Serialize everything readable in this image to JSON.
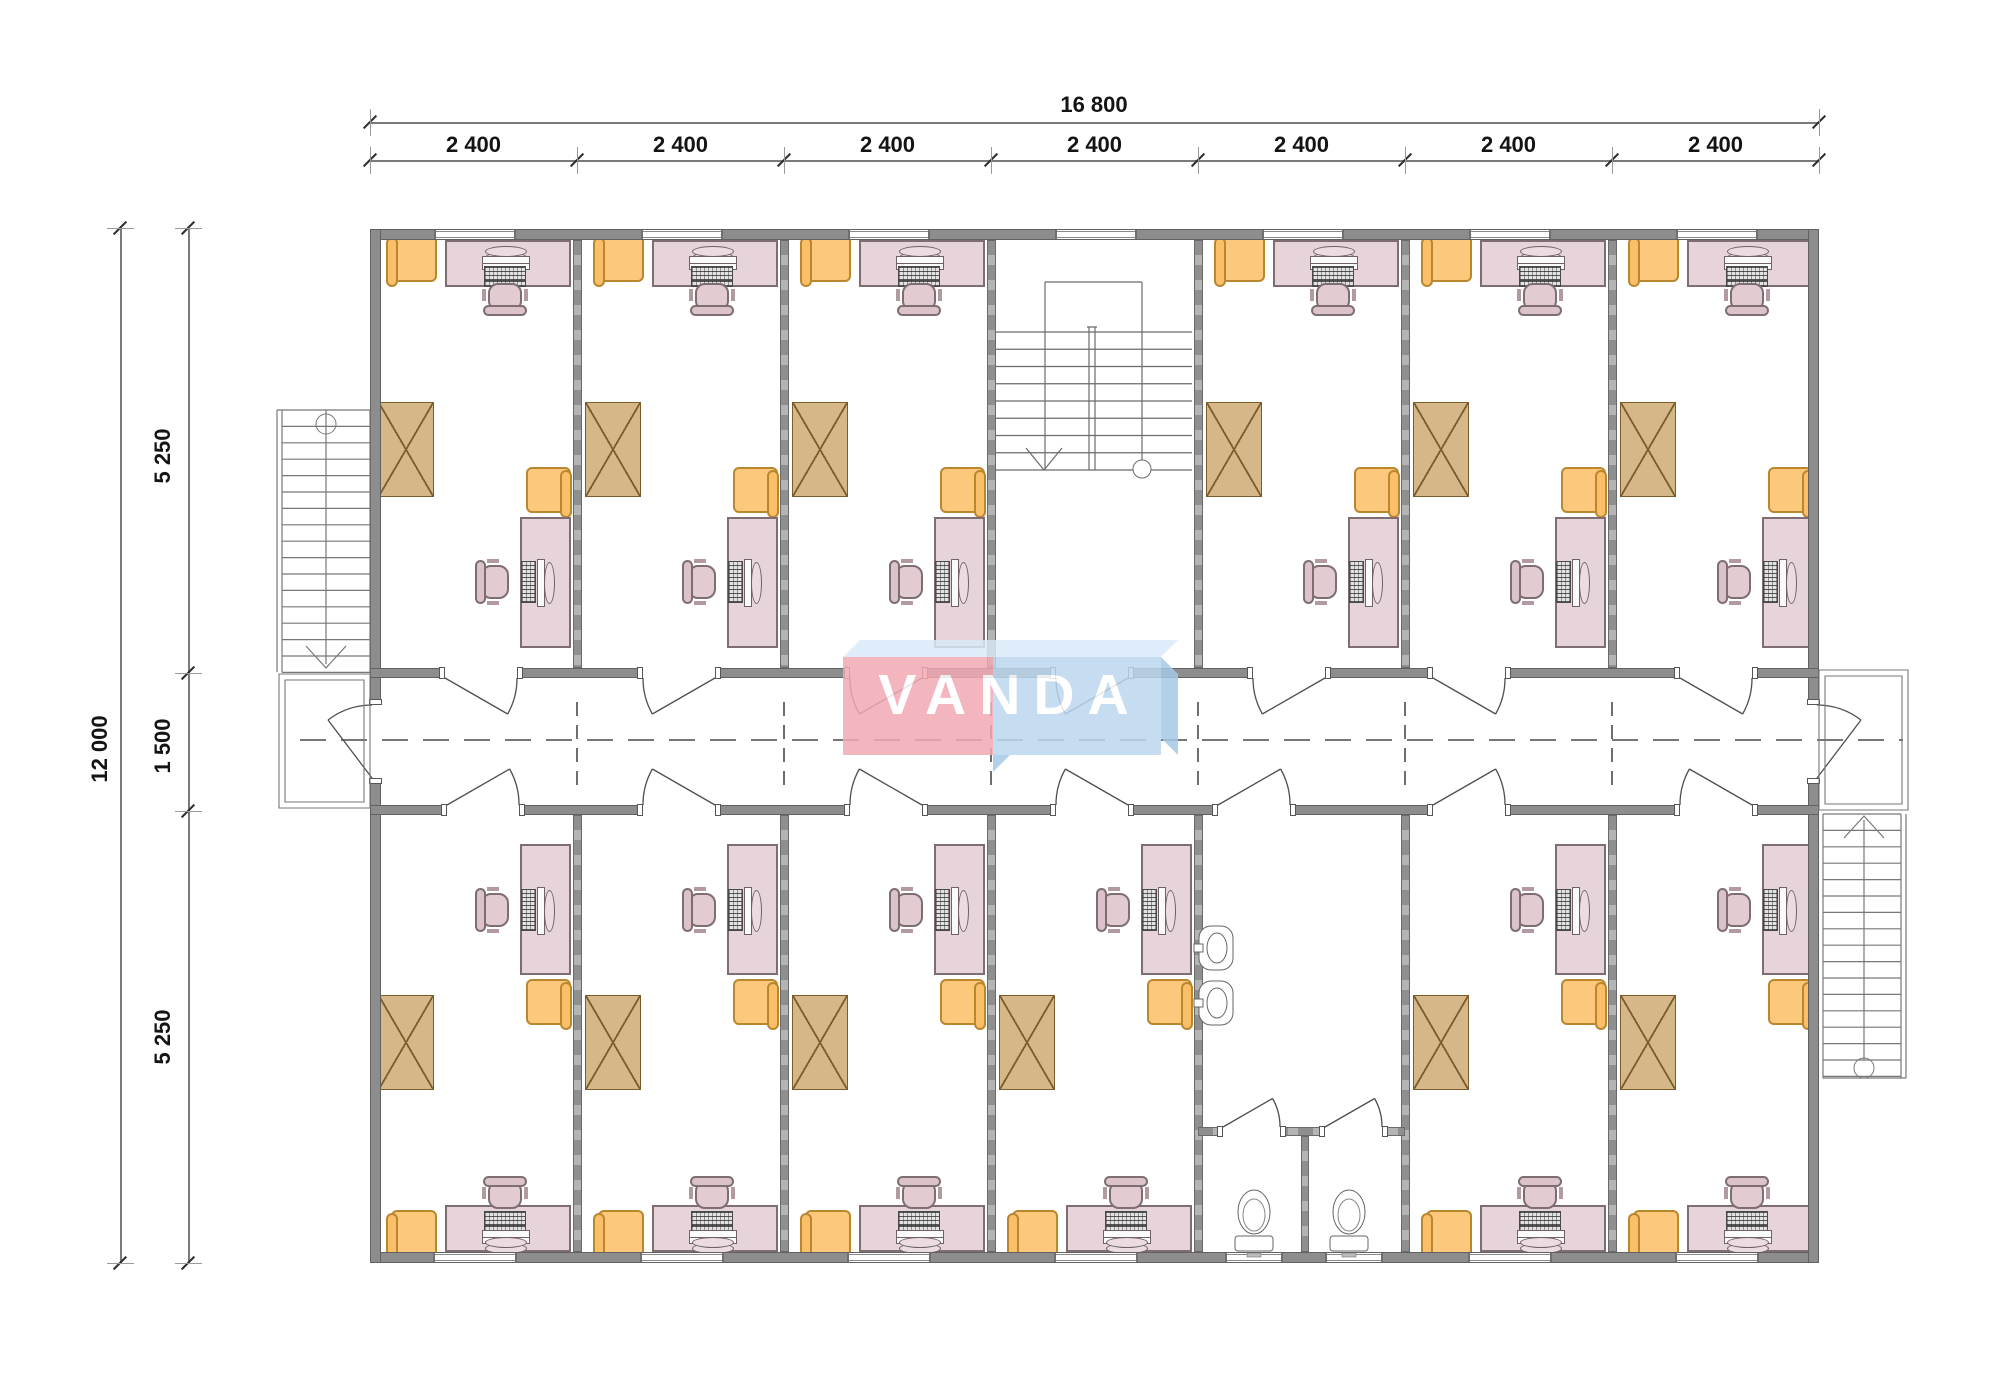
{
  "drawing": {
    "type": "office-floor-plan"
  },
  "logo": {
    "text": "VANDA",
    "pink": "#f2a9b3",
    "blue": "#bdd7ee",
    "top_face": "#d9eaf8",
    "side_face": "#a5c8e6"
  },
  "dimensions": {
    "top_total": "16 800",
    "top_segments": [
      "2 400",
      "2 400",
      "2 400",
      "2 400",
      "2 400",
      "2 400",
      "2 400"
    ],
    "left_total": "12 000",
    "left_segments": [
      "5 250",
      "1 500",
      "5 250"
    ]
  },
  "colors": {
    "wall": "#8d8d8d",
    "desk": "#e7d4da",
    "chair": "#e2ccd2",
    "armchair": "#fcc87c",
    "wardrobe": "#d6b787",
    "line": "#6f6f6f"
  }
}
